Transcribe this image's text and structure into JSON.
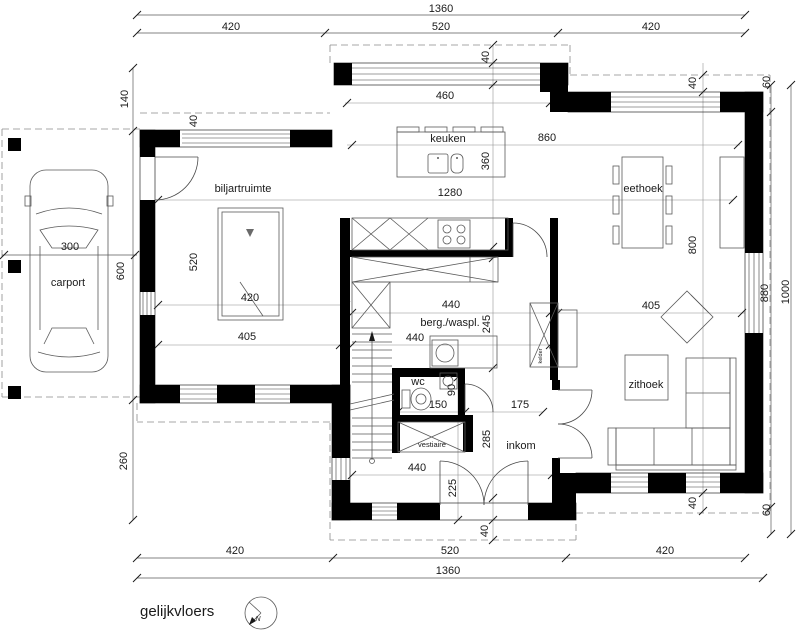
{
  "title": "gelijkvloers",
  "north_label": "N",
  "rooms": {
    "carport": "carport",
    "billiard": "biljartruimte",
    "kitchen": "keuken",
    "dining": "eethoek",
    "storage": "berg./waspl.",
    "wc": "wc",
    "cloak": "vestiaire",
    "hall": "inkom",
    "sitting": "zithoek",
    "cellar": "kelder"
  },
  "dims": {
    "t_total": "1360",
    "t_l": "420",
    "t_m": "520",
    "t_r": "420",
    "l_140": "140",
    "l_40": "40",
    "l_600": "600",
    "l_520": "520",
    "l_300": "300",
    "l_260": "260",
    "bil_420": "420",
    "bil_405": "405",
    "bay_40": "40",
    "bay_460": "460",
    "k_860": "860",
    "k_360": "360",
    "k_1280": "1280",
    "r_40t": "40",
    "r_60t": "60",
    "r_800": "800",
    "r_880": "880",
    "r_1000": "1000",
    "liv_405": "405",
    "r_40b": "40",
    "r_60b": "60",
    "s_440a": "440",
    "s_245": "245",
    "s_440b": "440",
    "wc_150": "150",
    "wc_90": "90",
    "in_175": "175",
    "in_285": "285",
    "in_440": "440",
    "in_225": "225",
    "b_40": "40",
    "b_l": "420",
    "b_m": "520",
    "b_r": "420",
    "b_total": "1360"
  },
  "colors": {
    "wall": "#000000",
    "line": "#5a5a5a",
    "dashed": "#8a8a8a"
  }
}
